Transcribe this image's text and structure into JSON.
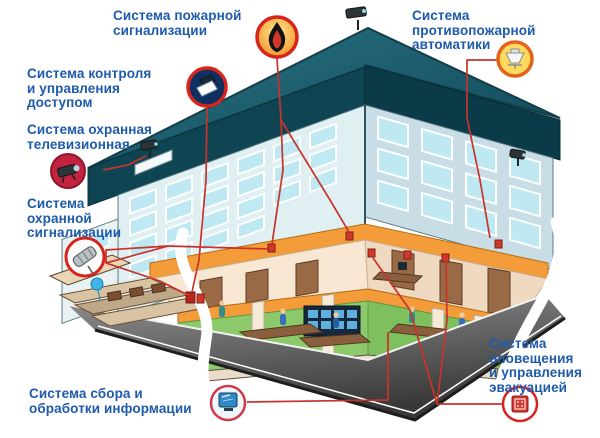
{
  "diagram": {
    "subject": "building-security-systems-cutaway",
    "language": "ru"
  },
  "labels": {
    "fire_alarm": {
      "lines": [
        "Система пожарной",
        "сигнализации"
      ]
    },
    "access_control": {
      "lines": [
        "Система контроля",
        "и управления",
        "доступом"
      ]
    },
    "cctv": {
      "lines": [
        "Система охранная",
        "телевизионная"
      ]
    },
    "security_alarm": {
      "lines": [
        "Система",
        "охранной",
        "сигнализации"
      ]
    },
    "info_processing": {
      "lines": [
        "Система сбора и",
        "обработки информации"
      ]
    },
    "fire_automation": {
      "lines": [
        "Система",
        "противопожарной",
        "автоматики"
      ]
    },
    "evacuation": {
      "lines": [
        "Система",
        "оповещения",
        "и управления",
        "эвакуацией"
      ]
    }
  },
  "icons": {
    "fire_alarm": "flame-icon",
    "access_control": "card-reader-icon",
    "cctv": "cctv-camera-icon",
    "security_alarm": "motion-sensor-icon",
    "info_processing": "computer-monitor-icon",
    "fire_automation": "sprinkler-icon",
    "evacuation": "alarm-box-icon"
  },
  "colors": {
    "label_text": "#1e5aab",
    "connector_line": "#c8332b",
    "icon_ring": "#d5251d",
    "roof": "#1b6170",
    "facade": "#dceef1",
    "floor_slab_orange": "#f49c3a",
    "carpet_green": "#8cc96a",
    "plaza_gray": "#585858"
  }
}
